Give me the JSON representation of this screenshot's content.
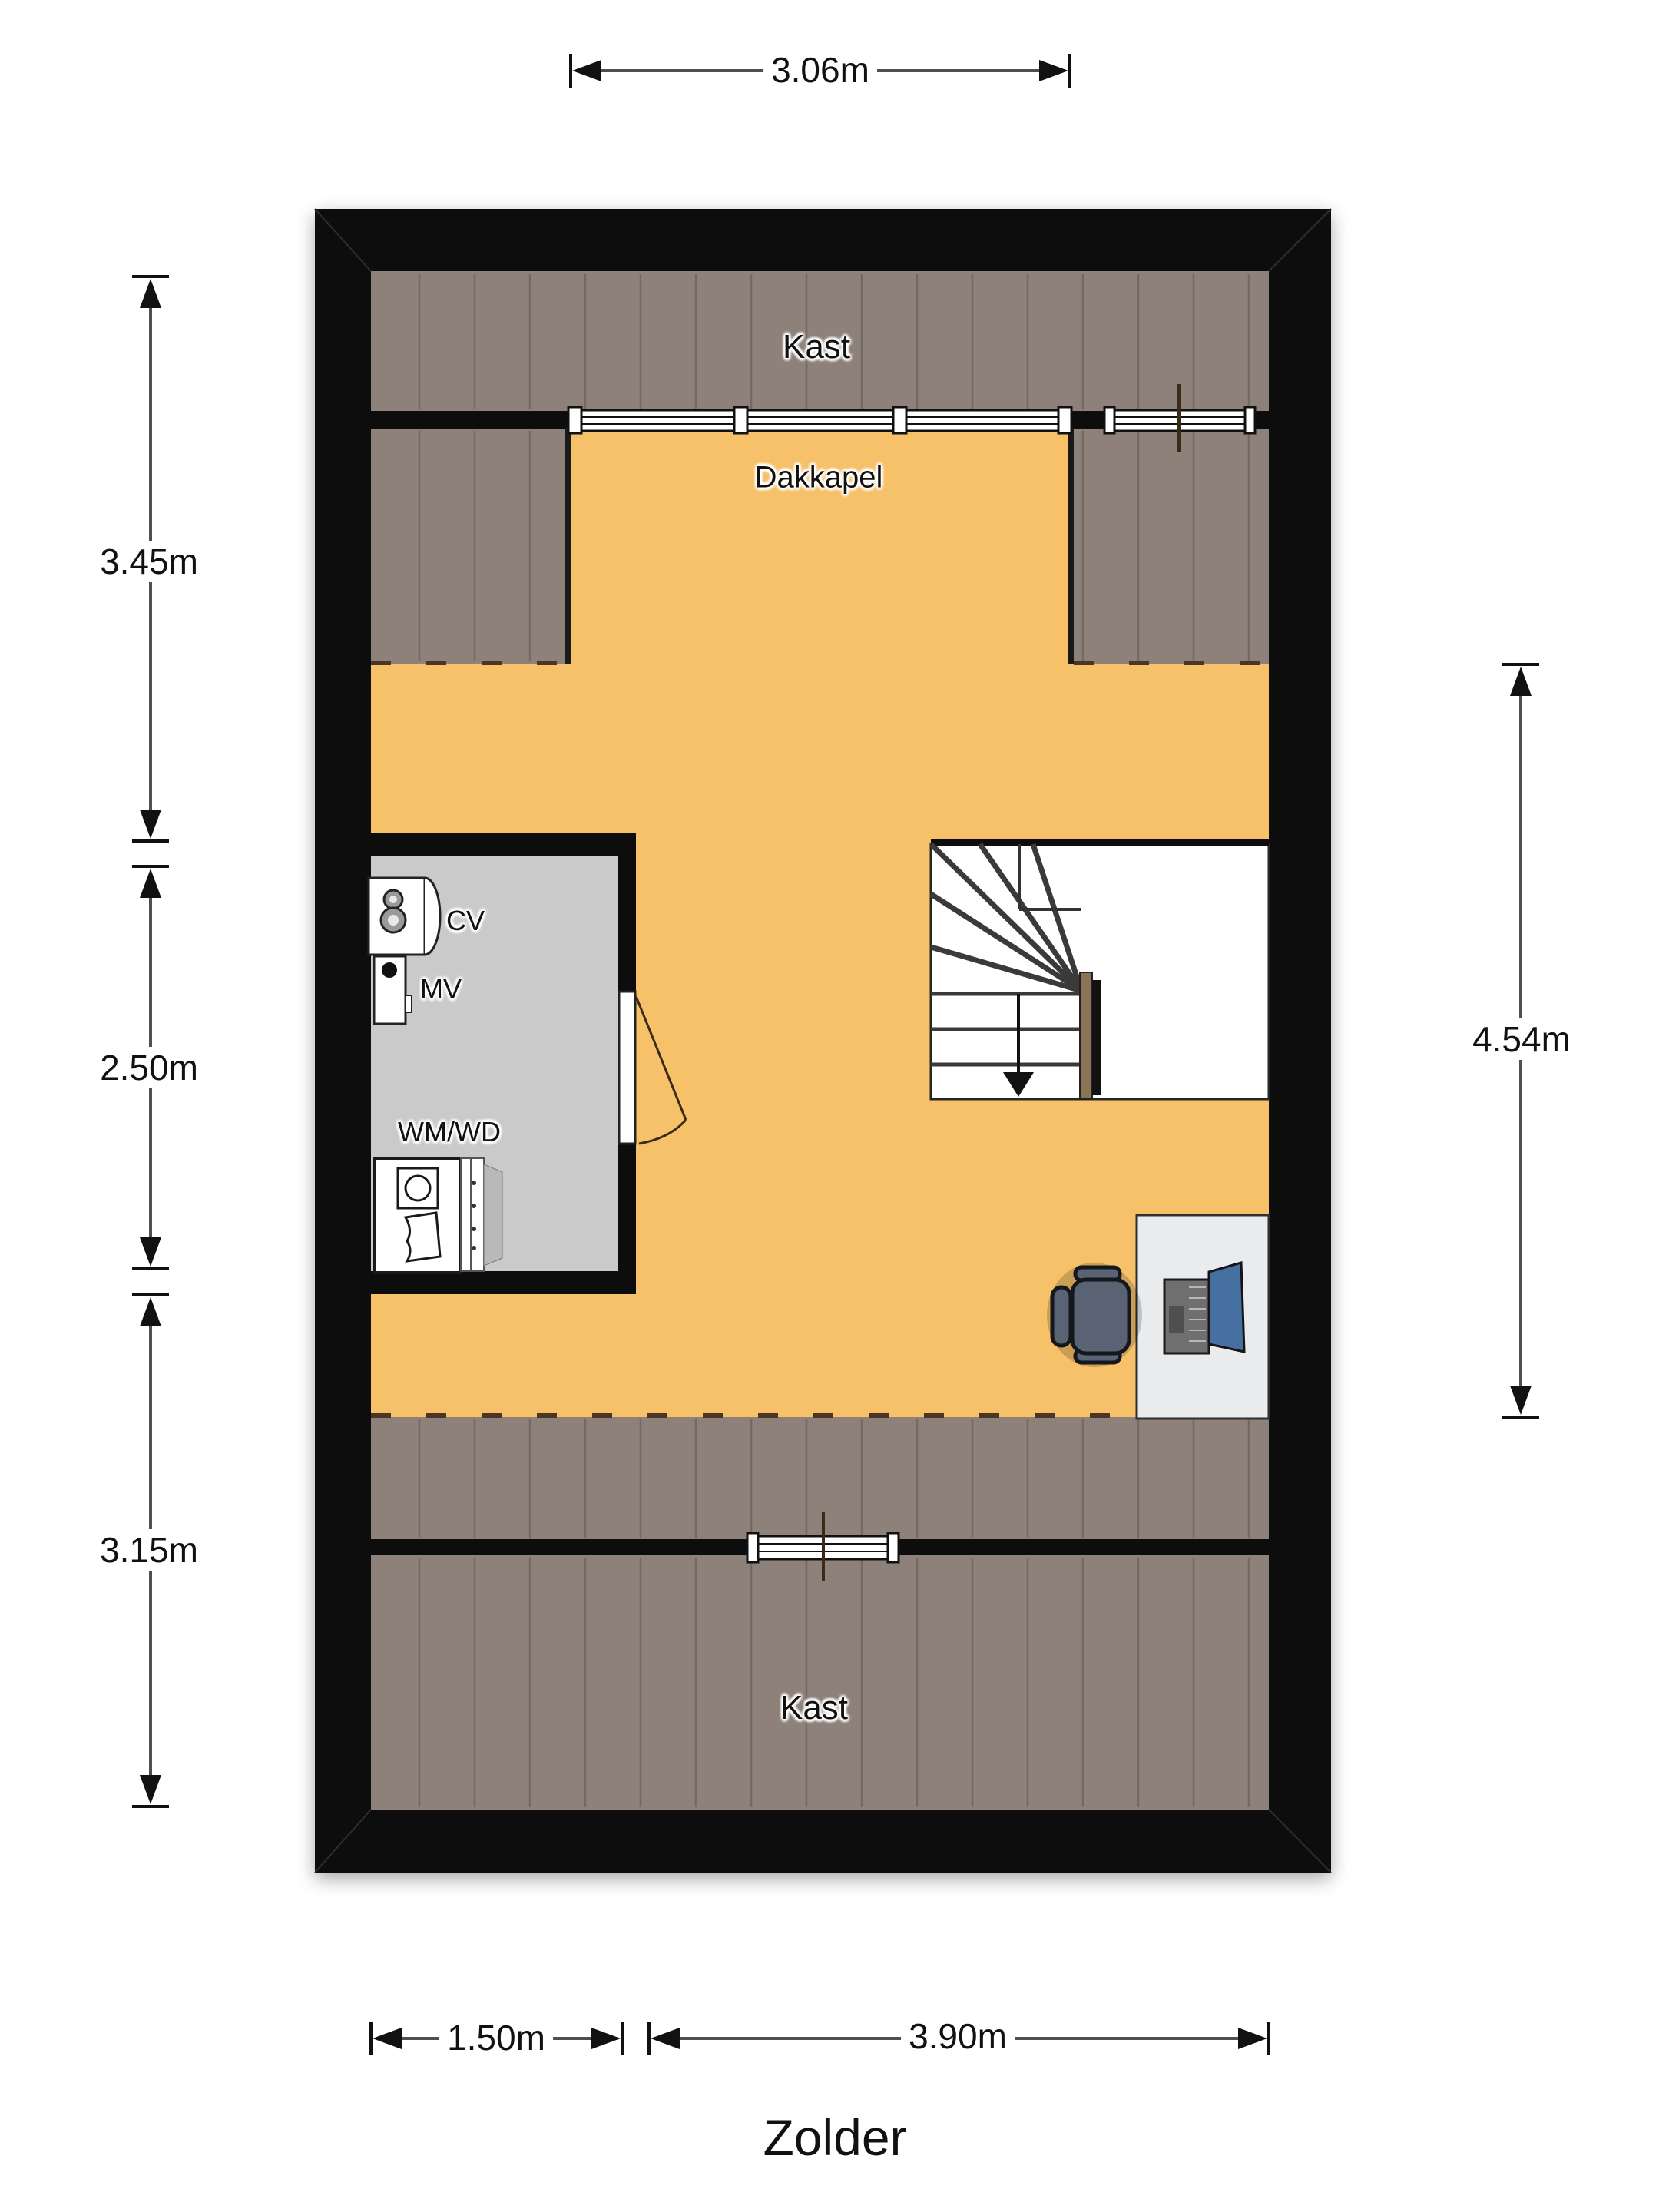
{
  "title": "Zolder",
  "room_labels": {
    "kast_top": "Kast",
    "dakkapel": "Dakkapel",
    "cv": "CV",
    "mv": "MV",
    "wm_wd": "WM/WD",
    "kast_bottom": "Kast"
  },
  "dimensions": {
    "top_width": "3.06m",
    "left_upper": "3.45m",
    "left_middle": "2.50m",
    "left_lower": "3.15m",
    "right_height": "4.54m",
    "bottom_left_width": "1.50m",
    "bottom_right_width": "3.90m"
  },
  "icons": {
    "stairs_down_arrow": "▼",
    "dimension_arrows": "◀ ▶",
    "cv_boiler": "keyhole-two-circles",
    "mv_vent": "black-dot",
    "washing_machine": "square-with-drum-circle",
    "laundry_basket": "wavy-basket",
    "laptop": "open-laptop-top-view",
    "office_chair": "swivel-chair-top-view",
    "door_swing": "door-leaf-with-quarter-arc",
    "window": "triple-line-frame"
  },
  "colors": {
    "wall": "#0d0d0d",
    "floor": "#f6c169",
    "roof": "#8d8179",
    "roofline": "#746a63",
    "techroom": "#cacaca",
    "dash": "#4a3526",
    "dimline": "#4f4f4f",
    "dimarrow": "#111111",
    "desk": "#e9ebed",
    "screen": "#46709f",
    "laptop": "#6f6f6f",
    "chair": "#5a6374",
    "newel": "#8b7355"
  }
}
